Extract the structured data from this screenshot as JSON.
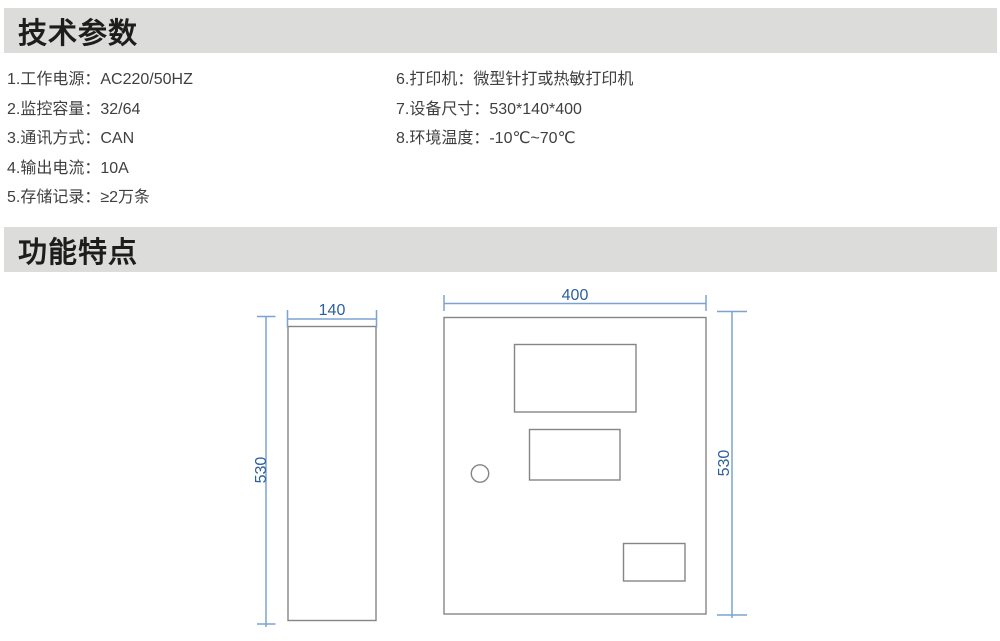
{
  "theme": {
    "page_bg": "#ffffff",
    "bar_bg": "#dcdcda",
    "header_text": "#1d1d1b",
    "body_text": "#3f3f3f",
    "dim_line_color": "#7ba3d0",
    "dim_text_color": "#2d5f9f",
    "outline_color": "#858585"
  },
  "sections": {
    "tech": {
      "title": "技术参数"
    },
    "features": {
      "title": "功能特点"
    }
  },
  "specs": {
    "left": [
      "1.工作电源：AC220/50HZ",
      "2.监控容量：32/64",
      "3.通讯方式：CAN",
      "4.输出电流：10A",
      "5.存储记录：≥2万条"
    ],
    "right": [
      "6.打印机：微型针打或热敏打印机",
      "7.设备尺寸：530*140*400",
      "8.环境温度：-10℃~70℃"
    ]
  },
  "drawing": {
    "type": "dimension-drawing",
    "description": "设备外形尺寸图：左侧视图与正视图",
    "views": {
      "side": {
        "width_label": "140",
        "height_label": "530"
      },
      "front": {
        "width_label": "400",
        "height_label": "530"
      }
    }
  }
}
